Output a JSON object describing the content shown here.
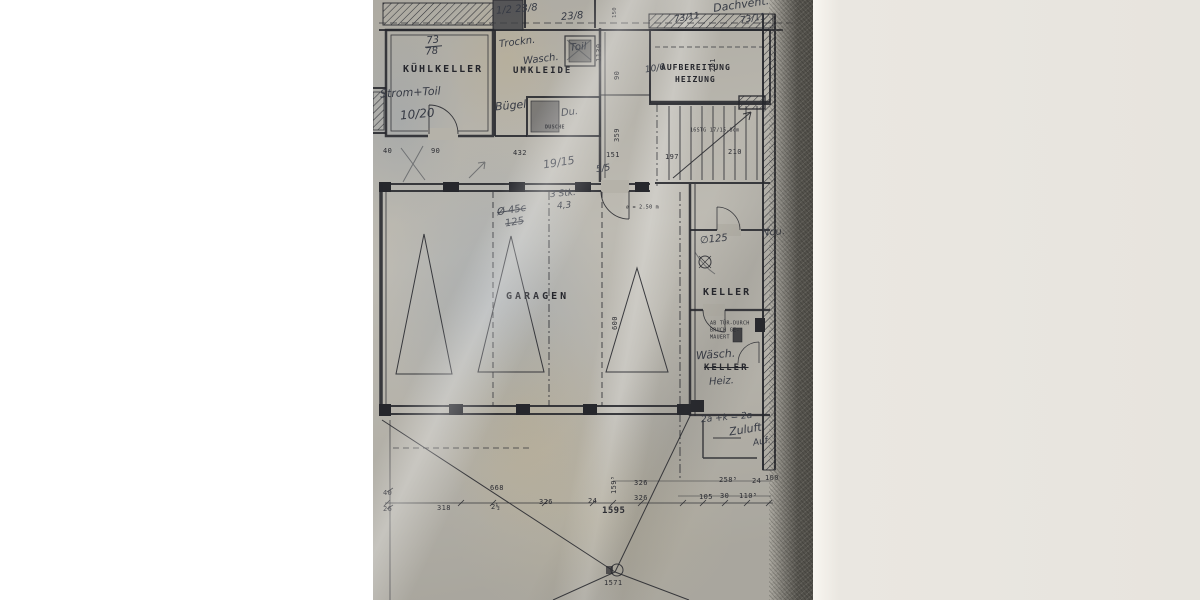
{
  "colors": {
    "paper": "#b6b3aa",
    "ink": "#26272c",
    "toner_band": "#56544e",
    "background_wall": "#eae7e1",
    "background_left": "#ffffff"
  },
  "rooms": {
    "kuehlkeller": "KÜHLKELLER",
    "umkleide": "UMKLEIDE",
    "aufbereitung1": "AUFBEREITUNG",
    "aufbereitung2": "HEIZUNG",
    "garagen": "GARAGEN",
    "keller_upper": "KELLER",
    "keller_lower": "KELLER",
    "dusche": "DUSCHE"
  },
  "notes": {
    "stairs": "16STG 17/15,8cm",
    "diameter": "⌀ = 2.50 m",
    "keller_note1": "AB TÜR-DURCH",
    "keller_note2": "BRUCH GE-",
    "keller_note3": "MAUERT"
  },
  "dims": {
    "v150": "150",
    "v1130": "1130",
    "v90": "90",
    "v359": "359",
    "v201": "201",
    "v600": "600",
    "v159": "159⁵",
    "h90": "90",
    "h40": "40",
    "h432": "432",
    "h151": "151",
    "h197": "197",
    "h210": "210",
    "b318": "318",
    "b668": "668",
    "b326a": "326",
    "b326b": "326",
    "b326c": "326",
    "b1595": "1595",
    "b1571": "1571",
    "b2h_a": "2½",
    "b24a": "24",
    "b24b": "24",
    "b258": "258⁵",
    "b100": "100",
    "b105": "105",
    "b30": "30",
    "b110": "110⁵",
    "b40": "40",
    "b26": "26"
  },
  "hand": {
    "dachvent": "Dachvent.",
    "frac1": "1/2 23/8",
    "frac2": "23/8",
    "frac3": "73/11",
    "frac4": "73/11",
    "frac5a": "73",
    "frac5b": "78",
    "trockn": "Trockn.",
    "wasch": "Wasch.",
    "toil": "Toil",
    "strom": "Strom+Toil",
    "s1020": "10/20",
    "buegel": "Bügel",
    "du": "Du.",
    "s106": "10/6",
    "s1915": "19/15",
    "s55": "5/5",
    "stk": "3 Stk.",
    "s43": "4,3",
    "o45": "Ø 45c",
    "s125": "125",
    "o125": "∅125",
    "nou": "Nou.",
    "waesch": "Wäsch.",
    "heiz": "Heiz.",
    "formula": "2a +k = 2a",
    "zuluft": "Zuluft",
    "auf": "Auf."
  }
}
